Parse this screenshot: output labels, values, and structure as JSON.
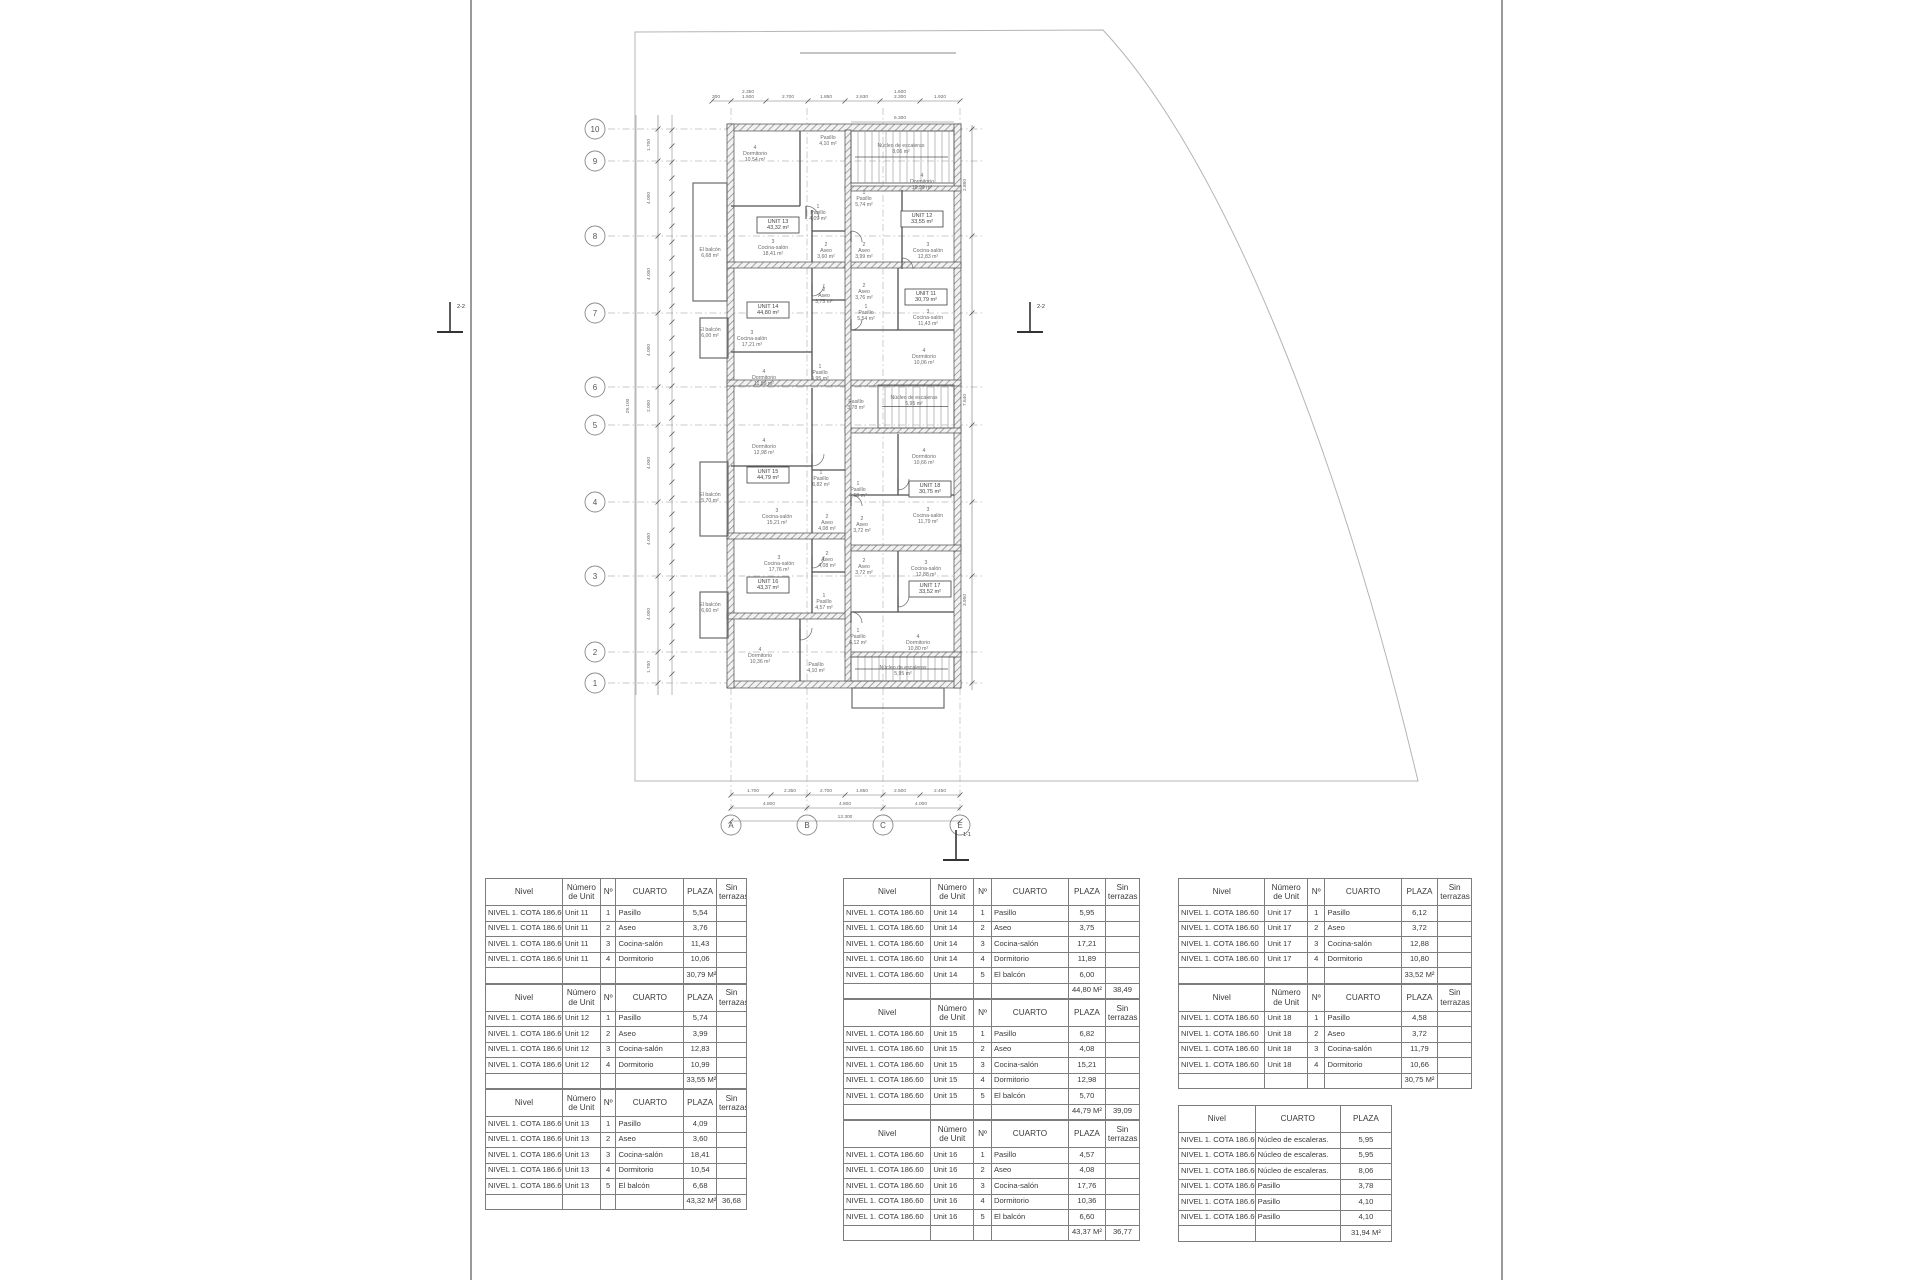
{
  "sheet": {
    "border_color": "#9a9a9a",
    "line_color": "#bdbdbd"
  },
  "plan": {
    "grid_rows": [
      {
        "label": "10",
        "y": 129
      },
      {
        "label": "9",
        "y": 161
      },
      {
        "label": "8",
        "y": 236
      },
      {
        "label": "7",
        "y": 313
      },
      {
        "label": "6",
        "y": 387
      },
      {
        "label": "5",
        "y": 425
      },
      {
        "label": "4",
        "y": 502
      },
      {
        "label": "3",
        "y": 576
      },
      {
        "label": "2",
        "y": 652
      },
      {
        "label": "1",
        "y": 683
      }
    ],
    "grid_cols": [
      {
        "label": "A",
        "x": 731
      },
      {
        "label": "B",
        "x": 807
      },
      {
        "label": "C",
        "x": 883
      },
      {
        "label": "E",
        "x": 960
      }
    ],
    "rooms": [
      {
        "n": "4",
        "name": "Dormitorio",
        "area": "10,54 m²",
        "x": 755,
        "y": 149
      },
      {
        "n": "",
        "name": "Pasillo",
        "area": "4,10 m²",
        "x": 828,
        "y": 139
      },
      {
        "n": "",
        "name": "Núcleo de escaleras",
        "area": "8,06 m²",
        "x": 901,
        "y": 147
      },
      {
        "n": "1",
        "name": "Pasillo",
        "area": "4,09 m²",
        "x": 818,
        "y": 208
      },
      {
        "n": "3",
        "name": "Cocina-salón",
        "area": "18,41 m²",
        "x": 773,
        "y": 243
      },
      {
        "n": "2",
        "name": "Aseo",
        "area": "3,60 m²",
        "x": 826,
        "y": 246
      },
      {
        "n": "",
        "name": "El balcón",
        "area": "6,68 m²",
        "x": 710,
        "y": 251
      },
      {
        "n": "1",
        "name": "Pasillo",
        "area": "5,74 m²",
        "x": 864,
        "y": 194
      },
      {
        "n": "4",
        "name": "Dormitorio",
        "area": "10,99 m²",
        "x": 922,
        "y": 177
      },
      {
        "n": "2",
        "name": "Aseo",
        "area": "3,99 m²",
        "x": 864,
        "y": 246
      },
      {
        "n": "3",
        "name": "Cocina-salón",
        "area": "12,83 m²",
        "x": 928,
        "y": 246
      },
      {
        "n": "2",
        "name": "Aseo",
        "area": "3,76 m²",
        "x": 864,
        "y": 287
      },
      {
        "n": "1",
        "name": "Pasillo",
        "area": "5,54 m²",
        "x": 866,
        "y": 308
      },
      {
        "n": "3",
        "name": "Cocina-salón",
        "area": "11,43 m²",
        "x": 928,
        "y": 313
      },
      {
        "n": "4",
        "name": "Dormitorio",
        "area": "10,06 m²",
        "x": 924,
        "y": 352
      },
      {
        "n": "2",
        "name": "Aseo",
        "area": "3,75 m²",
        "x": 824,
        "y": 291
      },
      {
        "n": "1",
        "name": "Pasillo",
        "area": "5,95 m²",
        "x": 820,
        "y": 368
      },
      {
        "n": "3",
        "name": "Cocina-salón",
        "area": "17,21 m²",
        "x": 752,
        "y": 334
      },
      {
        "n": "",
        "name": "El balcón",
        "area": "6,00 m²",
        "x": 710,
        "y": 331
      },
      {
        "n": "4",
        "name": "Dormitorio",
        "area": "11,89 m²",
        "x": 764,
        "y": 373
      },
      {
        "n": "",
        "name": "Pasillo",
        "area": "3,78 m²",
        "x": 856,
        "y": 403
      },
      {
        "n": "",
        "name": "Núcleo de escaleras",
        "area": "5,95 m²",
        "x": 914,
        "y": 399
      },
      {
        "n": "4",
        "name": "Dormitorio",
        "area": "12,98 m²",
        "x": 764,
        "y": 442
      },
      {
        "n": "1",
        "name": "Pasillo",
        "area": "6,82 m²",
        "x": 821,
        "y": 474
      },
      {
        "n": "3",
        "name": "Cocina-salón",
        "area": "15,21 m²",
        "x": 777,
        "y": 512
      },
      {
        "n": "2",
        "name": "Aseo",
        "area": "4,08 m²",
        "x": 827,
        "y": 518
      },
      {
        "n": "",
        "name": "El balcón",
        "area": "5,70 m²",
        "x": 710,
        "y": 496
      },
      {
        "n": "4",
        "name": "Dormitorio",
        "area": "10,66 m²",
        "x": 924,
        "y": 452
      },
      {
        "n": "1",
        "name": "Pasillo",
        "area": "4,58 m²",
        "x": 858,
        "y": 485
      },
      {
        "n": "3",
        "name": "Cocina-salón",
        "area": "11,79 m²",
        "x": 928,
        "y": 511
      },
      {
        "n": "2",
        "name": "Aseo",
        "area": "3,72 m²",
        "x": 862,
        "y": 520
      },
      {
        "n": "3",
        "name": "Cocina-salón",
        "area": "17,76 m²",
        "x": 779,
        "y": 559
      },
      {
        "n": "2",
        "name": "Aseo",
        "area": "4,08 m²",
        "x": 827,
        "y": 555
      },
      {
        "n": "1",
        "name": "Pasillo",
        "area": "4,57 m²",
        "x": 824,
        "y": 597
      },
      {
        "n": "",
        "name": "El balcón",
        "area": "6,60 m²",
        "x": 710,
        "y": 606
      },
      {
        "n": "4",
        "name": "Dormitorio",
        "area": "10,36 m²",
        "x": 760,
        "y": 651
      },
      {
        "n": "2",
        "name": "Aseo",
        "area": "3,72 m²",
        "x": 864,
        "y": 562
      },
      {
        "n": "3",
        "name": "Cocina-salón",
        "area": "12,88 m²",
        "x": 926,
        "y": 564
      },
      {
        "n": "1",
        "name": "Pasillo",
        "area": "6,12 m²",
        "x": 858,
        "y": 632
      },
      {
        "n": "4",
        "name": "Dormitorio",
        "area": "10,80 m²",
        "x": 918,
        "y": 638
      },
      {
        "n": "",
        "name": "Pasillo",
        "area": "4,10 m²",
        "x": 816,
        "y": 666
      },
      {
        "n": "",
        "name": "Núcleo de escaleras",
        "area": "5,95 m²",
        "x": 903,
        "y": 669
      }
    ],
    "unit_boxes": [
      {
        "label": "UNIT 13",
        "area": "43,32 m²",
        "x": 778,
        "y": 224
      },
      {
        "label": "UNIT 12",
        "area": "33,55 m²",
        "x": 922,
        "y": 218
      },
      {
        "label": "UNIT 11",
        "area": "30,79 m²",
        "x": 926,
        "y": 296
      },
      {
        "label": "UNIT 14",
        "area": "44,80 m²",
        "x": 768,
        "y": 309
      },
      {
        "label": "UNIT 15",
        "area": "44,79 m²",
        "x": 768,
        "y": 474
      },
      {
        "label": "UNIT 18",
        "area": "30,75 m²",
        "x": 930,
        "y": 488
      },
      {
        "label": "UNIT 16",
        "area": "43,37 m²",
        "x": 768,
        "y": 584
      },
      {
        "label": "UNIT 17",
        "area": "33,52 m²",
        "x": 930,
        "y": 588
      }
    ],
    "dims_top": [
      {
        "t": "300",
        "x": 716
      },
      {
        "t": "1.500",
        "x": 748,
        "stack": "2.350"
      },
      {
        "t": "2.700",
        "x": 788
      },
      {
        "t": "1.850",
        "x": 826
      },
      {
        "t": "2.630",
        "x": 862
      },
      {
        "t": "2.300",
        "x": 900,
        "stack": "1.600"
      },
      {
        "t": "1.920",
        "x": 940
      }
    ],
    "dim_top_extra": {
      "t": "6.300",
      "x": 900,
      "y": 119
    },
    "dims_bottom": [
      {
        "t": "1.700",
        "x": 753
      },
      {
        "t": "2.350",
        "x": 790
      },
      {
        "t": "2.700",
        "x": 826
      },
      {
        "t": "1.850",
        "x": 862
      },
      {
        "t": "2.500",
        "x": 900
      },
      {
        "t": "2.450",
        "x": 940
      }
    ],
    "dims_bottom_totals": [
      {
        "t": "4.800",
        "x": 769
      },
      {
        "t": "4.800",
        "x": 845
      },
      {
        "t": "4.000",
        "x": 921
      }
    ],
    "dim_bottom_grand": {
      "t": "12.300",
      "x": 845
    },
    "dims_left": [
      {
        "t": "1.700",
        "y": 145
      },
      {
        "t": "4.000",
        "y": 198
      },
      {
        "t": "4.000",
        "y": 274
      },
      {
        "t": "4.000",
        "y": 350
      },
      {
        "t": "2.000",
        "y": 406
      },
      {
        "t": "4.000",
        "y": 463
      },
      {
        "t": "4.000",
        "y": 539
      },
      {
        "t": "4.000",
        "y": 614
      },
      {
        "t": "1.700",
        "y": 667
      }
    ],
    "dim_left_total": {
      "t": "29.100",
      "y": 406
    },
    "dims_right": [
      {
        "t": "2.850",
        "y": 185
      },
      {
        "t": "7.640",
        "y": 400
      },
      {
        "t": "3.950",
        "y": 600
      }
    ],
    "sections": [
      {
        "label": "2-2",
        "x": 450,
        "y": 318
      },
      {
        "label": "2-2",
        "x": 1030,
        "y": 318
      },
      {
        "label": "1-1",
        "x": 956,
        "y": 846
      }
    ]
  },
  "tables": {
    "header": {
      "nivel": "Nivel",
      "numero": "Número de Unit",
      "no": "Nº",
      "cuarto": "CUARTO",
      "plaza": "PLAZA",
      "sin": "Sin terrazas"
    },
    "nivel_value": "NIVEL 1. COTA 186.60",
    "unit_tables": [
      {
        "col": 0,
        "unit": "Unit 11",
        "rows": [
          [
            "1",
            "Pasillo",
            "5,54"
          ],
          [
            "2",
            "Aseo",
            "3,76"
          ],
          [
            "3",
            "Cocina-salón",
            "11,43"
          ],
          [
            "4",
            "Dormitorio",
            "10,06"
          ]
        ],
        "total": "30,79 M²",
        "total_sin": ""
      },
      {
        "col": 0,
        "unit": "Unit 12",
        "rows": [
          [
            "1",
            "Pasillo",
            "5,74"
          ],
          [
            "2",
            "Aseo",
            "3,99"
          ],
          [
            "3",
            "Cocina-salón",
            "12,83"
          ],
          [
            "4",
            "Dormitorio",
            "10,99"
          ]
        ],
        "total": "33,55 M²",
        "total_sin": ""
      },
      {
        "col": 0,
        "unit": "Unit 13",
        "rows": [
          [
            "1",
            "Pasillo",
            "4,09"
          ],
          [
            "2",
            "Aseo",
            "3,60"
          ],
          [
            "3",
            "Cocina-salón",
            "18,41"
          ],
          [
            "4",
            "Dormitorio",
            "10,54"
          ],
          [
            "5",
            "El balcón",
            "6,68"
          ]
        ],
        "total": "43,32 M²",
        "total_sin": "36,68"
      },
      {
        "col": 1,
        "unit": "Unit 14",
        "rows": [
          [
            "1",
            "Pasillo",
            "5,95"
          ],
          [
            "2",
            "Aseo",
            "3,75"
          ],
          [
            "3",
            "Cocina-salón",
            "17,21"
          ],
          [
            "4",
            "Dormitorio",
            "11,89"
          ],
          [
            "5",
            "El balcón",
            "6,00"
          ]
        ],
        "total": "44,80 M²",
        "total_sin": "38,49"
      },
      {
        "col": 1,
        "unit": "Unit 15",
        "rows": [
          [
            "1",
            "Pasillo",
            "6,82"
          ],
          [
            "2",
            "Aseo",
            "4,08"
          ],
          [
            "3",
            "Cocina-salón",
            "15,21"
          ],
          [
            "4",
            "Dormitorio",
            "12,98"
          ],
          [
            "5",
            "El balcón",
            "5,70"
          ]
        ],
        "total": "44,79 M²",
        "total_sin": "39,09"
      },
      {
        "col": 1,
        "unit": "Unit 16",
        "rows": [
          [
            "1",
            "Pasillo",
            "4,57"
          ],
          [
            "2",
            "Aseo",
            "4,08"
          ],
          [
            "3",
            "Cocina-salón",
            "17,76"
          ],
          [
            "4",
            "Dormitorio",
            "10,36"
          ],
          [
            "5",
            "El balcón",
            "6,60"
          ]
        ],
        "total": "43,37 M²",
        "total_sin": "36,77"
      },
      {
        "col": 2,
        "unit": "Unit 17",
        "rows": [
          [
            "1",
            "Pasillo",
            "6,12"
          ],
          [
            "2",
            "Aseo",
            "3,72"
          ],
          [
            "3",
            "Cocina-salón",
            "12,88"
          ],
          [
            "4",
            "Dormitorio",
            "10,80"
          ]
        ],
        "total": "33,52 M²",
        "total_sin": ""
      },
      {
        "col": 2,
        "unit": "Unit 18",
        "rows": [
          [
            "1",
            "Pasillo",
            "4,58"
          ],
          [
            "2",
            "Aseo",
            "3,72"
          ],
          [
            "3",
            "Cocina-salón",
            "11,79"
          ],
          [
            "4",
            "Dormitorio",
            "10,66"
          ]
        ],
        "total": "30,75 M²",
        "total_sin": ""
      }
    ],
    "common_table": {
      "headers": [
        "Nivel",
        "CUARTO",
        "PLAZA"
      ],
      "rows": [
        [
          "Núcleo de escaleras.",
          "5,95"
        ],
        [
          "Núcleo de escaleras.",
          "5,95"
        ],
        [
          "Núcleo de escaleras.",
          "8,06"
        ],
        [
          "Pasillo",
          "3,78"
        ],
        [
          "Pasillo",
          "4,10"
        ],
        [
          "Pasillo",
          "4,10"
        ]
      ],
      "total": "31,94 M²"
    }
  }
}
